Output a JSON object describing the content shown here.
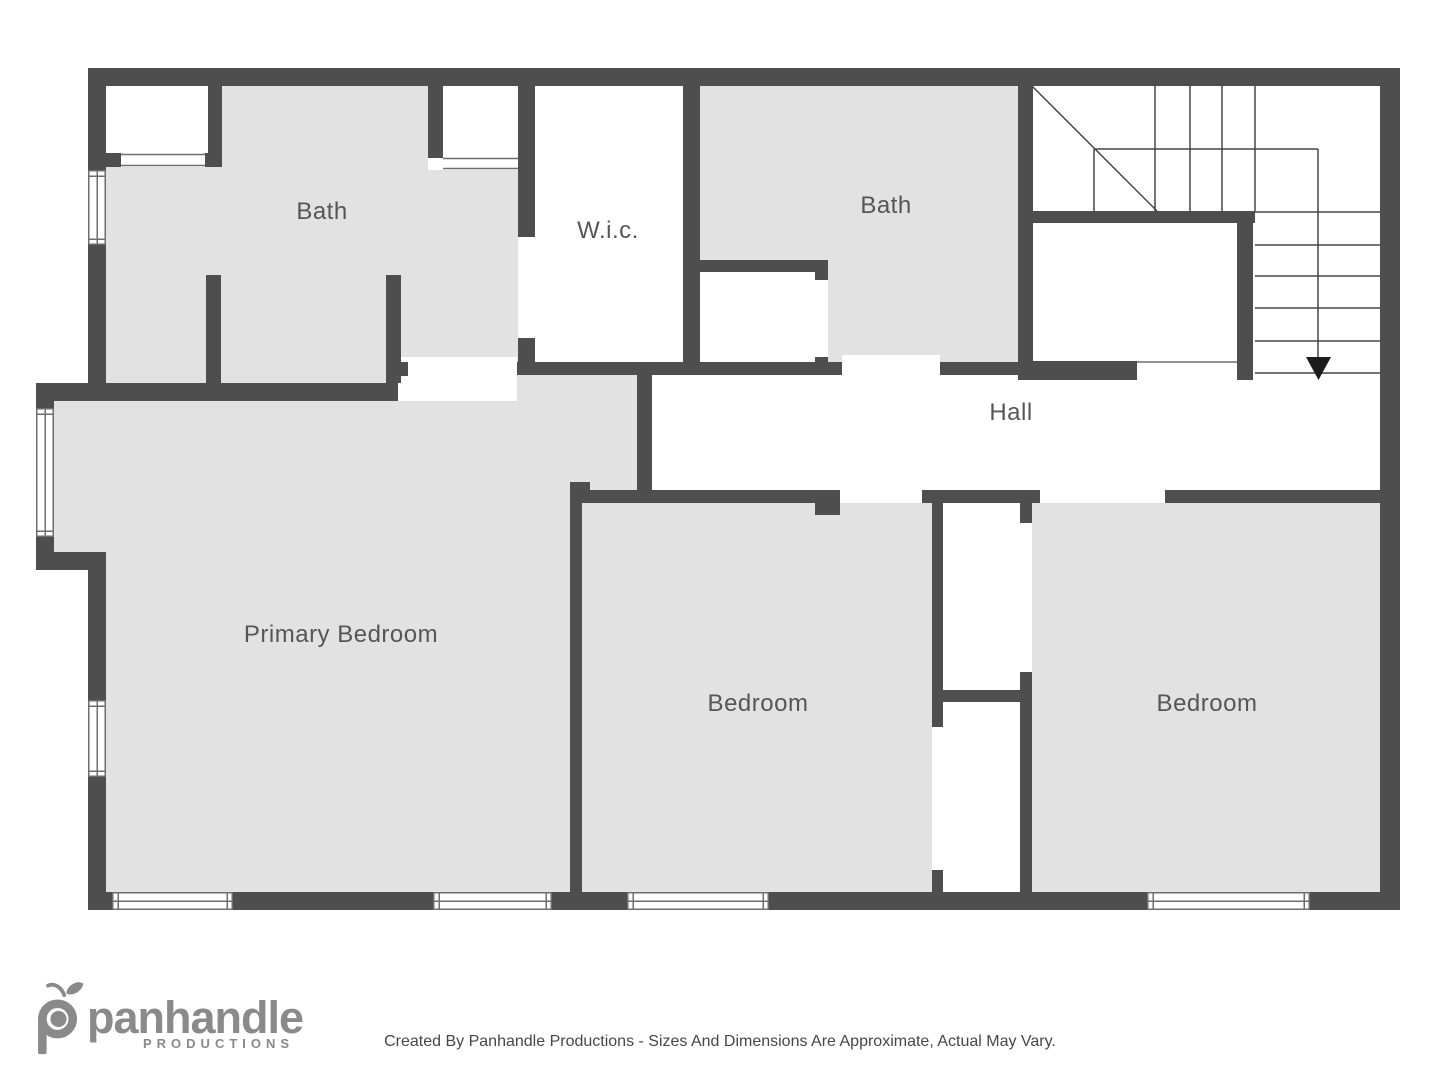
{
  "colors": {
    "background": "#ffffff",
    "wall": "#4e4e4e",
    "floor": "#e2e2e2",
    "line": "#6e6e6e",
    "stair": "#454545",
    "label_text": "#565656",
    "logo": "#8a8a8a",
    "disclaimer_text": "#474747",
    "arrow": "#1c1c1c"
  },
  "rooms": {
    "labels": [
      {
        "id": "bath-1",
        "text": "Bath",
        "x": 322,
        "y": 212
      },
      {
        "id": "wic",
        "text": "W.i.c.",
        "x": 608,
        "y": 231
      },
      {
        "id": "bath-2",
        "text": "Bath",
        "x": 886,
        "y": 206
      },
      {
        "id": "hall",
        "text": "Hall",
        "x": 1011,
        "y": 413
      },
      {
        "id": "primary-bedroom",
        "text": "Primary Bedroom",
        "x": 341,
        "y": 635
      },
      {
        "id": "bedroom-middle",
        "text": "Bedroom",
        "x": 758,
        "y": 704
      },
      {
        "id": "bedroom-right",
        "text": "Bedroom",
        "x": 1207,
        "y": 704
      }
    ]
  },
  "branding": {
    "logo_text": "panhandle",
    "logo_subtext": "PRODUCTIONS",
    "disclaimer": "Created By Panhandle Productions - Sizes And Dimensions Are Approximate, Actual May Vary."
  }
}
